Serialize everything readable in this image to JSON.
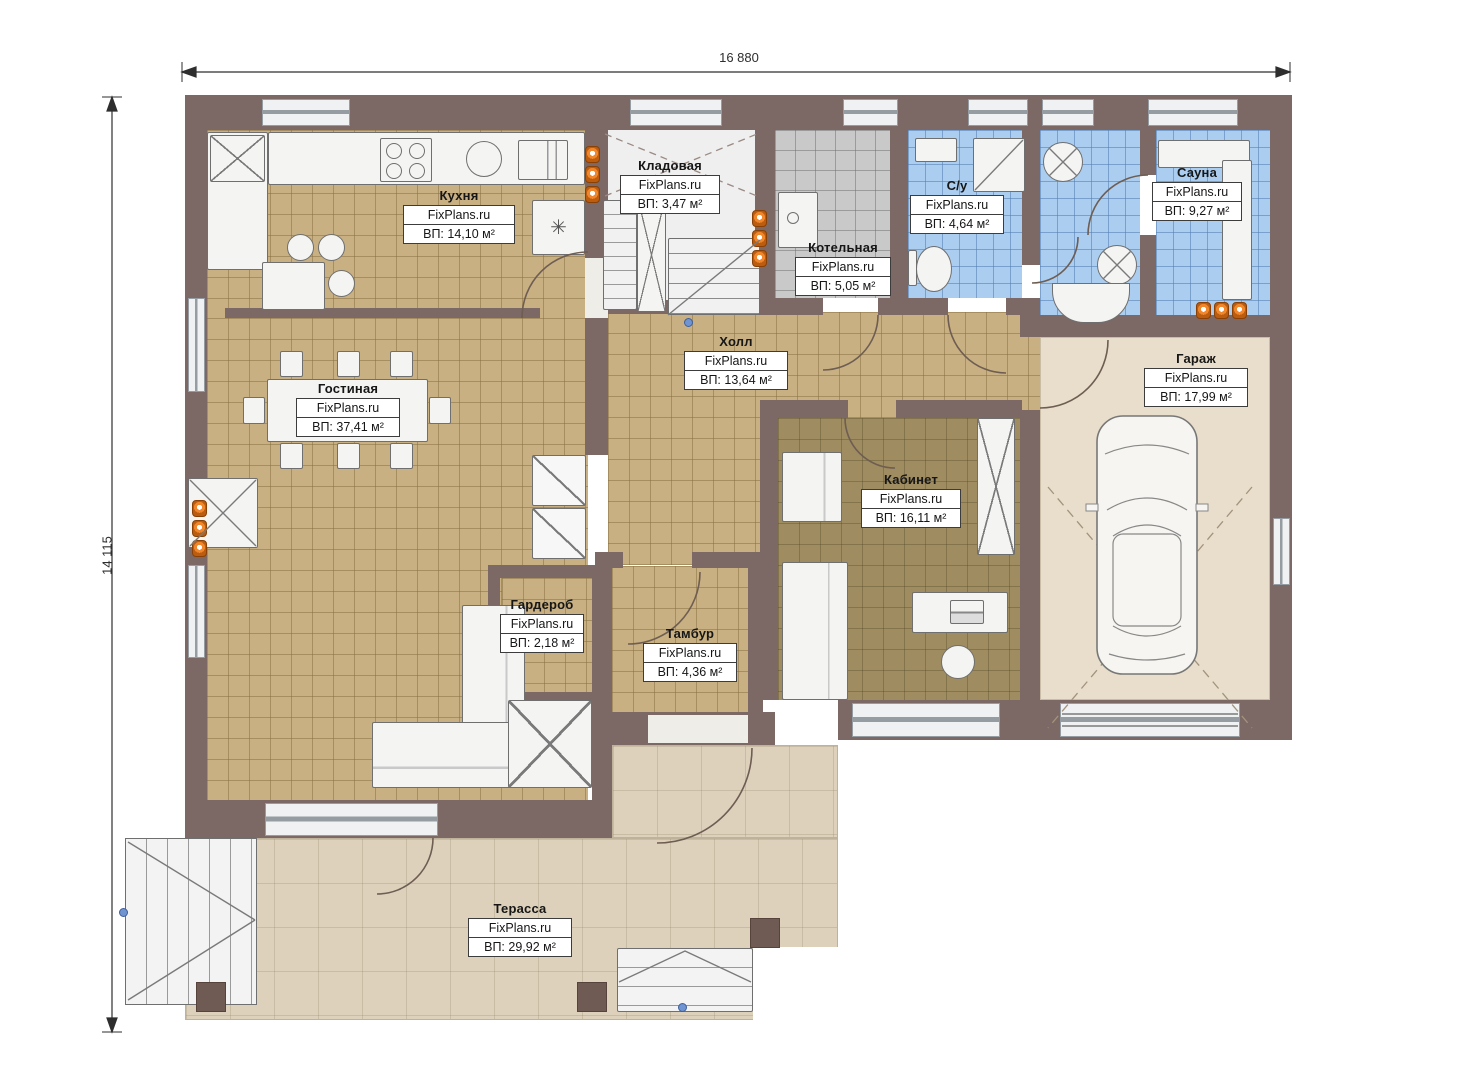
{
  "plan": {
    "top_dimension": "16 880",
    "left_dimension": "14 115"
  },
  "rooms": [
    {
      "id": "kitchen",
      "name": "Кухня",
      "watermark": "FixPlans.ru",
      "area": "ВП: 14,10 м²"
    },
    {
      "id": "storage",
      "name": "Кладовая",
      "watermark": "FixPlans.ru",
      "area": "ВП: 3,47 м²"
    },
    {
      "id": "boiler",
      "name": "Котельная",
      "watermark": "FixPlans.ru",
      "area": "ВП: 5,05 м²"
    },
    {
      "id": "wc",
      "name": "С/у",
      "watermark": "FixPlans.ru",
      "area": "ВП: 4,64 м²"
    },
    {
      "id": "sauna",
      "name": "Сауна",
      "watermark": "FixPlans.ru",
      "area": "ВП: 9,27 м²"
    },
    {
      "id": "hall",
      "name": "Холл",
      "watermark": "FixPlans.ru",
      "area": "ВП: 13,64 м²"
    },
    {
      "id": "living",
      "name": "Гостиная",
      "watermark": "FixPlans.ru",
      "area": "ВП: 37,41 м²"
    },
    {
      "id": "garage",
      "name": "Гараж",
      "watermark": "FixPlans.ru",
      "area": "ВП: 17,99 м²"
    },
    {
      "id": "office",
      "name": "Кабинет",
      "watermark": "FixPlans.ru",
      "area": "ВП: 16,11 м²"
    },
    {
      "id": "wardrobe",
      "name": "Гардероб",
      "watermark": "FixPlans.ru",
      "area": "ВП: 2,18 м²"
    },
    {
      "id": "vestibule",
      "name": "Тамбур",
      "watermark": "FixPlans.ru",
      "area": "ВП: 4,36 м²"
    },
    {
      "id": "terrace",
      "name": "Терасса",
      "watermark": "FixPlans.ru",
      "area": "ВП: 29,92 м²"
    }
  ],
  "colors": {
    "wall": "#7c6864",
    "floor_tan": "#c8b082",
    "floor_blue": "#abcdef",
    "floor_gray": "#c9c9c9",
    "floor_office": "#9f8c60",
    "floor_garage": "#e8decb",
    "floor_terrace": "#ddd1bc",
    "radiator": "#f0872c"
  }
}
